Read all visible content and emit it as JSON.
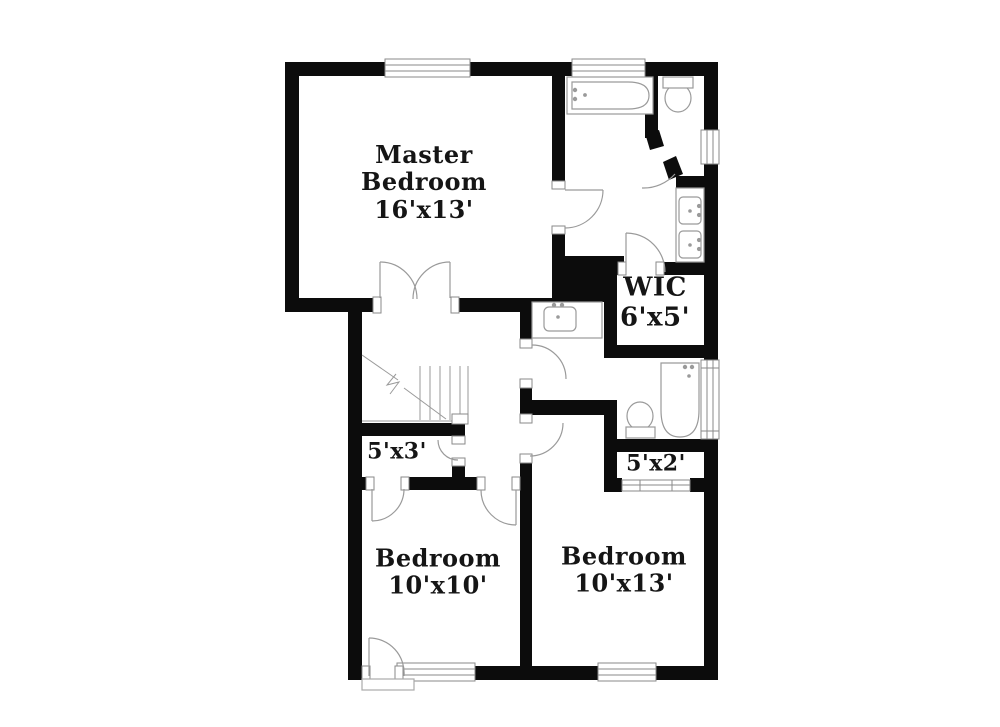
{
  "title": "Second floor plan",
  "colors": {
    "background": "#ffffff",
    "wall": "#0c0c0c",
    "fixture_line": "#999999",
    "text": "#151515"
  },
  "rooms": [
    {
      "id": "master-bedroom",
      "name": "Master Bedroom",
      "dimensions": "16'x13'"
    },
    {
      "id": "wic",
      "name": "WIC",
      "dimensions": "6'x5'"
    },
    {
      "id": "closet-5x3",
      "name": "",
      "dimensions": "5'x3'"
    },
    {
      "id": "closet-5x2",
      "name": "",
      "dimensions": "5'x2'"
    },
    {
      "id": "bedroom-10x10",
      "name": "Bedroom",
      "dimensions": "10'x10'"
    },
    {
      "id": "bedroom-10x13",
      "name": "Bedroom",
      "dimensions": "10'x13'"
    }
  ]
}
